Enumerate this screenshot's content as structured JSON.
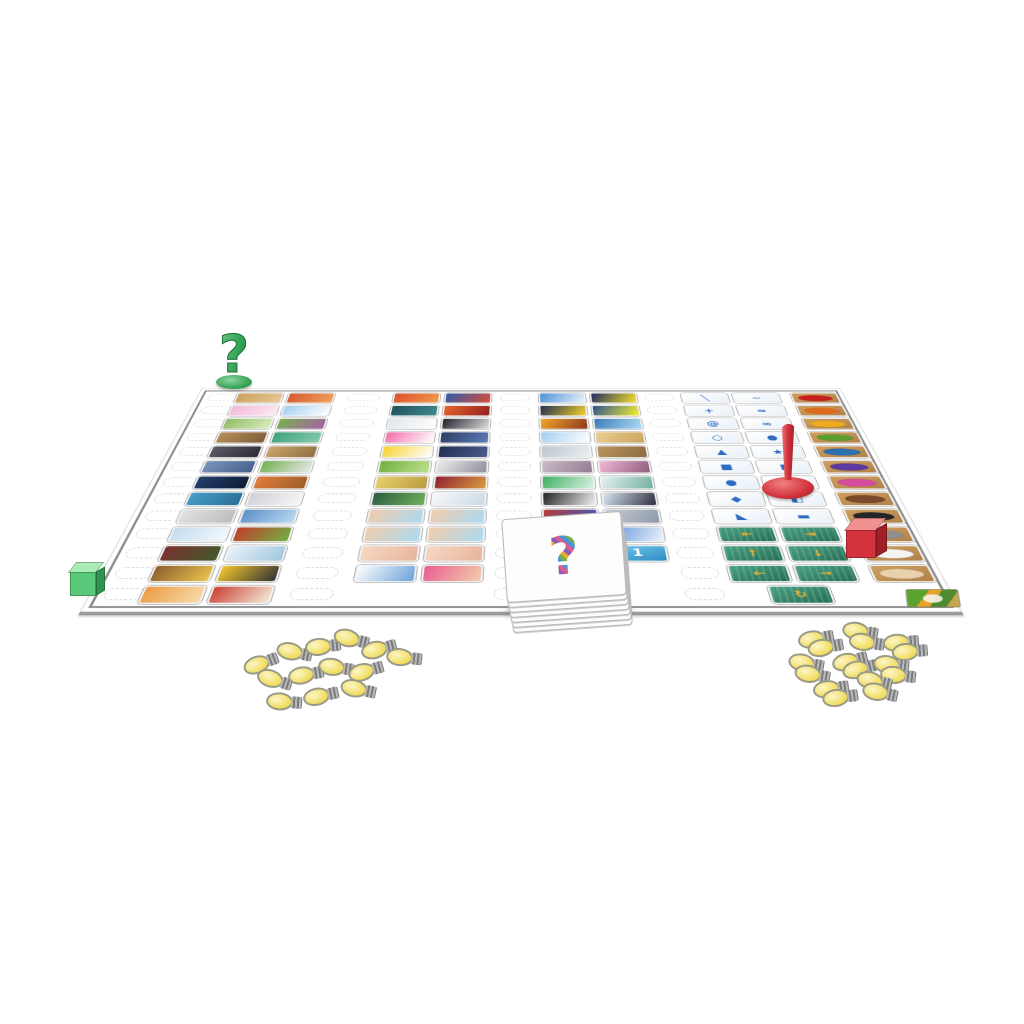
{
  "page": {
    "background": "#ffffff",
    "board_border": "#8f8f8f"
  },
  "board": {
    "tiles": {
      "g1a": [
        [
          "#caa05f",
          "#e8c794"
        ],
        [
          "#f2b8d8",
          "#fde8f2"
        ],
        [
          "#8fbe62",
          "#d9ecc0"
        ],
        [
          "#b9905c",
          "#7d5c36"
        ],
        [
          "#5c5c68",
          "#2c2c36"
        ],
        [
          "#7c94ba",
          "#43608c"
        ],
        [
          "#24406e",
          "#0f1b33"
        ],
        [
          "#47a0c9",
          "#2a6e94"
        ],
        [
          "#e2e2e2",
          "#bcbcbc"
        ],
        [
          "#c3dcee",
          "#f2f8fc"
        ],
        [
          "#7c3030",
          "#3f5a2a"
        ],
        [
          "#8c5c2e",
          "#eac44e"
        ],
        [
          "#ec9a42",
          "#f8dcae"
        ]
      ],
      "g1b": [
        [
          "#d4562e",
          "#f2a35c"
        ],
        [
          "#a2cff2",
          "#ffffff"
        ],
        [
          "#78b24e",
          "#a65ea6"
        ],
        [
          "#40a07c",
          "#84ccac"
        ],
        [
          "#cba66c",
          "#8f7040"
        ],
        [
          "#70b050",
          "#e8e8e8"
        ],
        [
          "#e27e3c",
          "#9e5c28"
        ],
        [
          "#cfcfd6",
          "#f7f7f7"
        ],
        [
          "#5c90c6",
          "#bad9f2"
        ],
        [
          "#c43c2e",
          "#70b040"
        ],
        [
          "#eaf3fa",
          "#a0c6e0"
        ],
        [
          "#f2c62c",
          "#343434"
        ],
        [
          "#cc4034",
          "#f2ead8"
        ]
      ],
      "g2a": [
        [
          "#da502e",
          "#f29c4c"
        ],
        [
          "#20505c",
          "#40898f"
        ],
        [
          "#dde6ec",
          "#ffffff"
        ],
        [
          "#f26caa",
          "#ffffff"
        ],
        [
          "#f6d22c",
          "#ffffff"
        ],
        [
          "#70b040",
          "#bce08c"
        ],
        [
          "#ead06c",
          "#b89c40"
        ],
        [
          "#2c5c40",
          "#70b05c"
        ],
        [
          "#f2ccaa",
          "#aadaf2"
        ],
        [
          "#f2ccaa",
          "#aadaf2"
        ],
        [
          "#f6d8c4",
          "#e8b49c"
        ],
        [
          "#ffffff",
          "#6ca2da"
        ]
      ],
      "g2b": [
        [
          "#2e5caa",
          "#da4c3c"
        ],
        [
          "#ea642c",
          "#8f2020"
        ],
        [
          "#22222e",
          "#dcdcdc"
        ],
        [
          "#2c3c60",
          "#5c7cba"
        ],
        [
          "#202c50",
          "#4c5c90"
        ],
        [
          "#ececec",
          "#9090a0"
        ],
        [
          "#90202e",
          "#da9c40"
        ],
        [
          "#f8f8f8",
          "#cadae8"
        ],
        [
          "#f2ccaa",
          "#aadaf2"
        ],
        [
          "#f2ccaa",
          "#aadaf2"
        ],
        [
          "#f6d8c4",
          "#e8b49c"
        ],
        [
          "#e85c90",
          "#f2ccaa"
        ]
      ],
      "g3a": [
        [
          "#4c90da",
          "#eaf3fa"
        ],
        [
          "#202c50",
          "#f6d22c"
        ],
        [
          "#f2a62c",
          "#90381e"
        ],
        [
          "#a2cff2",
          "#ffffff"
        ],
        [
          "#bcc6ce",
          "#eaeef2"
        ],
        [
          "#ccbcc6",
          "#907c90"
        ],
        [
          "#40b060",
          "#daf2e2"
        ],
        [
          "#222222",
          "#f2f2f2"
        ],
        [
          "#ba3a3a",
          "#3a5aba"
        ],
        [
          "#f4f4f4",
          "#da3a3a"
        ],
        {
          "t": "num",
          "g": "0"
        }
      ],
      "g3b": [
        [
          "#202c60",
          "#f6e22c"
        ],
        [
          "#2c5090",
          "#f6f22c"
        ],
        [
          "#3a7cba",
          "#aadaf2"
        ],
        [
          "#eace90",
          "#caa560"
        ],
        [
          "#ba9460",
          "#8c6c40"
        ],
        [
          "#f2b8d8",
          "#905c7c"
        ],
        [
          "#eaf2f4",
          "#70b0a0"
        ],
        [
          "#dae8f2",
          "#2e2e40"
        ],
        [
          "#c6ced6",
          "#909aa8"
        ],
        [
          "#5c90da",
          "#eaf2fa"
        ],
        {
          "t": "num",
          "g": "1"
        }
      ],
      "g4a": [
        {
          "t": "sym",
          "g": "╲"
        },
        {
          "t": "sym",
          "g": "+"
        },
        {
          "t": "sym",
          "g": "@"
        },
        {
          "t": "sym",
          "g": "○"
        },
        {
          "t": "sym",
          "g": "▲"
        },
        {
          "t": "sym",
          "g": "■"
        },
        {
          "t": "sym",
          "g": "●"
        },
        {
          "t": "sym",
          "g": "◆"
        },
        {
          "t": "sym",
          "g": "◣"
        },
        {
          "t": "dir",
          "g": "⇤"
        },
        {
          "t": "dir",
          "g": "↑"
        },
        {
          "t": "dir",
          "g": "←"
        }
      ],
      "g4b": [
        {
          "t": "sym",
          "g": "~"
        },
        {
          "t": "sym",
          "g": "≈"
        },
        {
          "t": "sym",
          "g": "∞"
        },
        {
          "t": "sym",
          "g": "●"
        },
        {
          "t": "sym",
          "g": "★"
        },
        {
          "t": "sym",
          "g": "▮"
        },
        {
          "t": "sym",
          "g": "◔"
        },
        {
          "t": "sym",
          "g": "◧"
        },
        {
          "t": "sym",
          "g": "▬"
        },
        {
          "t": "dir",
          "g": "⇥"
        },
        {
          "t": "dir",
          "g": "↓"
        },
        {
          "t": "dir",
          "g": "→"
        }
      ],
      "colors": [
        "#c81e1e",
        "#e06a1c",
        "#eeac1c",
        "#5c9e2e",
        "#2e6fae",
        "#5c3a9e",
        "#d84a9e",
        "#7c4a2a",
        "#262626",
        "#8f8f8f",
        "#f4f4f4",
        "#e8d2ae"
      ]
    },
    "rotate_tile": {
      "t": "dir",
      "g": "↻"
    },
    "slot_columns": 5
  },
  "pieces": {
    "question_pawn": {
      "glyph": "?",
      "color": "#2e9e4e"
    },
    "exclaim_pawn": {
      "glyph": "!",
      "color": "#d2333c"
    },
    "green_cube": {
      "color": "#59c879"
    },
    "red_cube": {
      "color": "#d2333c"
    },
    "card_stack": {
      "glyph": "?",
      "cards": 8
    },
    "bulbs_left": {
      "type": "single",
      "count": 13,
      "positions": [
        [
          243,
          650,
          -20
        ],
        [
          276,
          641,
          12
        ],
        [
          305,
          634,
          -6
        ],
        [
          333,
          628,
          14
        ],
        [
          361,
          636,
          -14
        ],
        [
          386,
          646,
          6
        ],
        [
          256,
          669,
          18
        ],
        [
          288,
          662,
          -10
        ],
        [
          318,
          656,
          8
        ],
        [
          348,
          658,
          -16
        ],
        [
          266,
          690,
          4
        ],
        [
          303,
          683,
          -12
        ],
        [
          340,
          678,
          12
        ]
      ]
    },
    "bulbs_right": {
      "type": "double",
      "count": 8,
      "positions": [
        [
          798,
          626,
          -10
        ],
        [
          842,
          620,
          8
        ],
        [
          883,
          630,
          -5
        ],
        [
          788,
          652,
          10
        ],
        [
          832,
          648,
          -14
        ],
        [
          873,
          653,
          6
        ],
        [
          813,
          676,
          -8
        ],
        [
          856,
          670,
          12
        ]
      ]
    }
  }
}
